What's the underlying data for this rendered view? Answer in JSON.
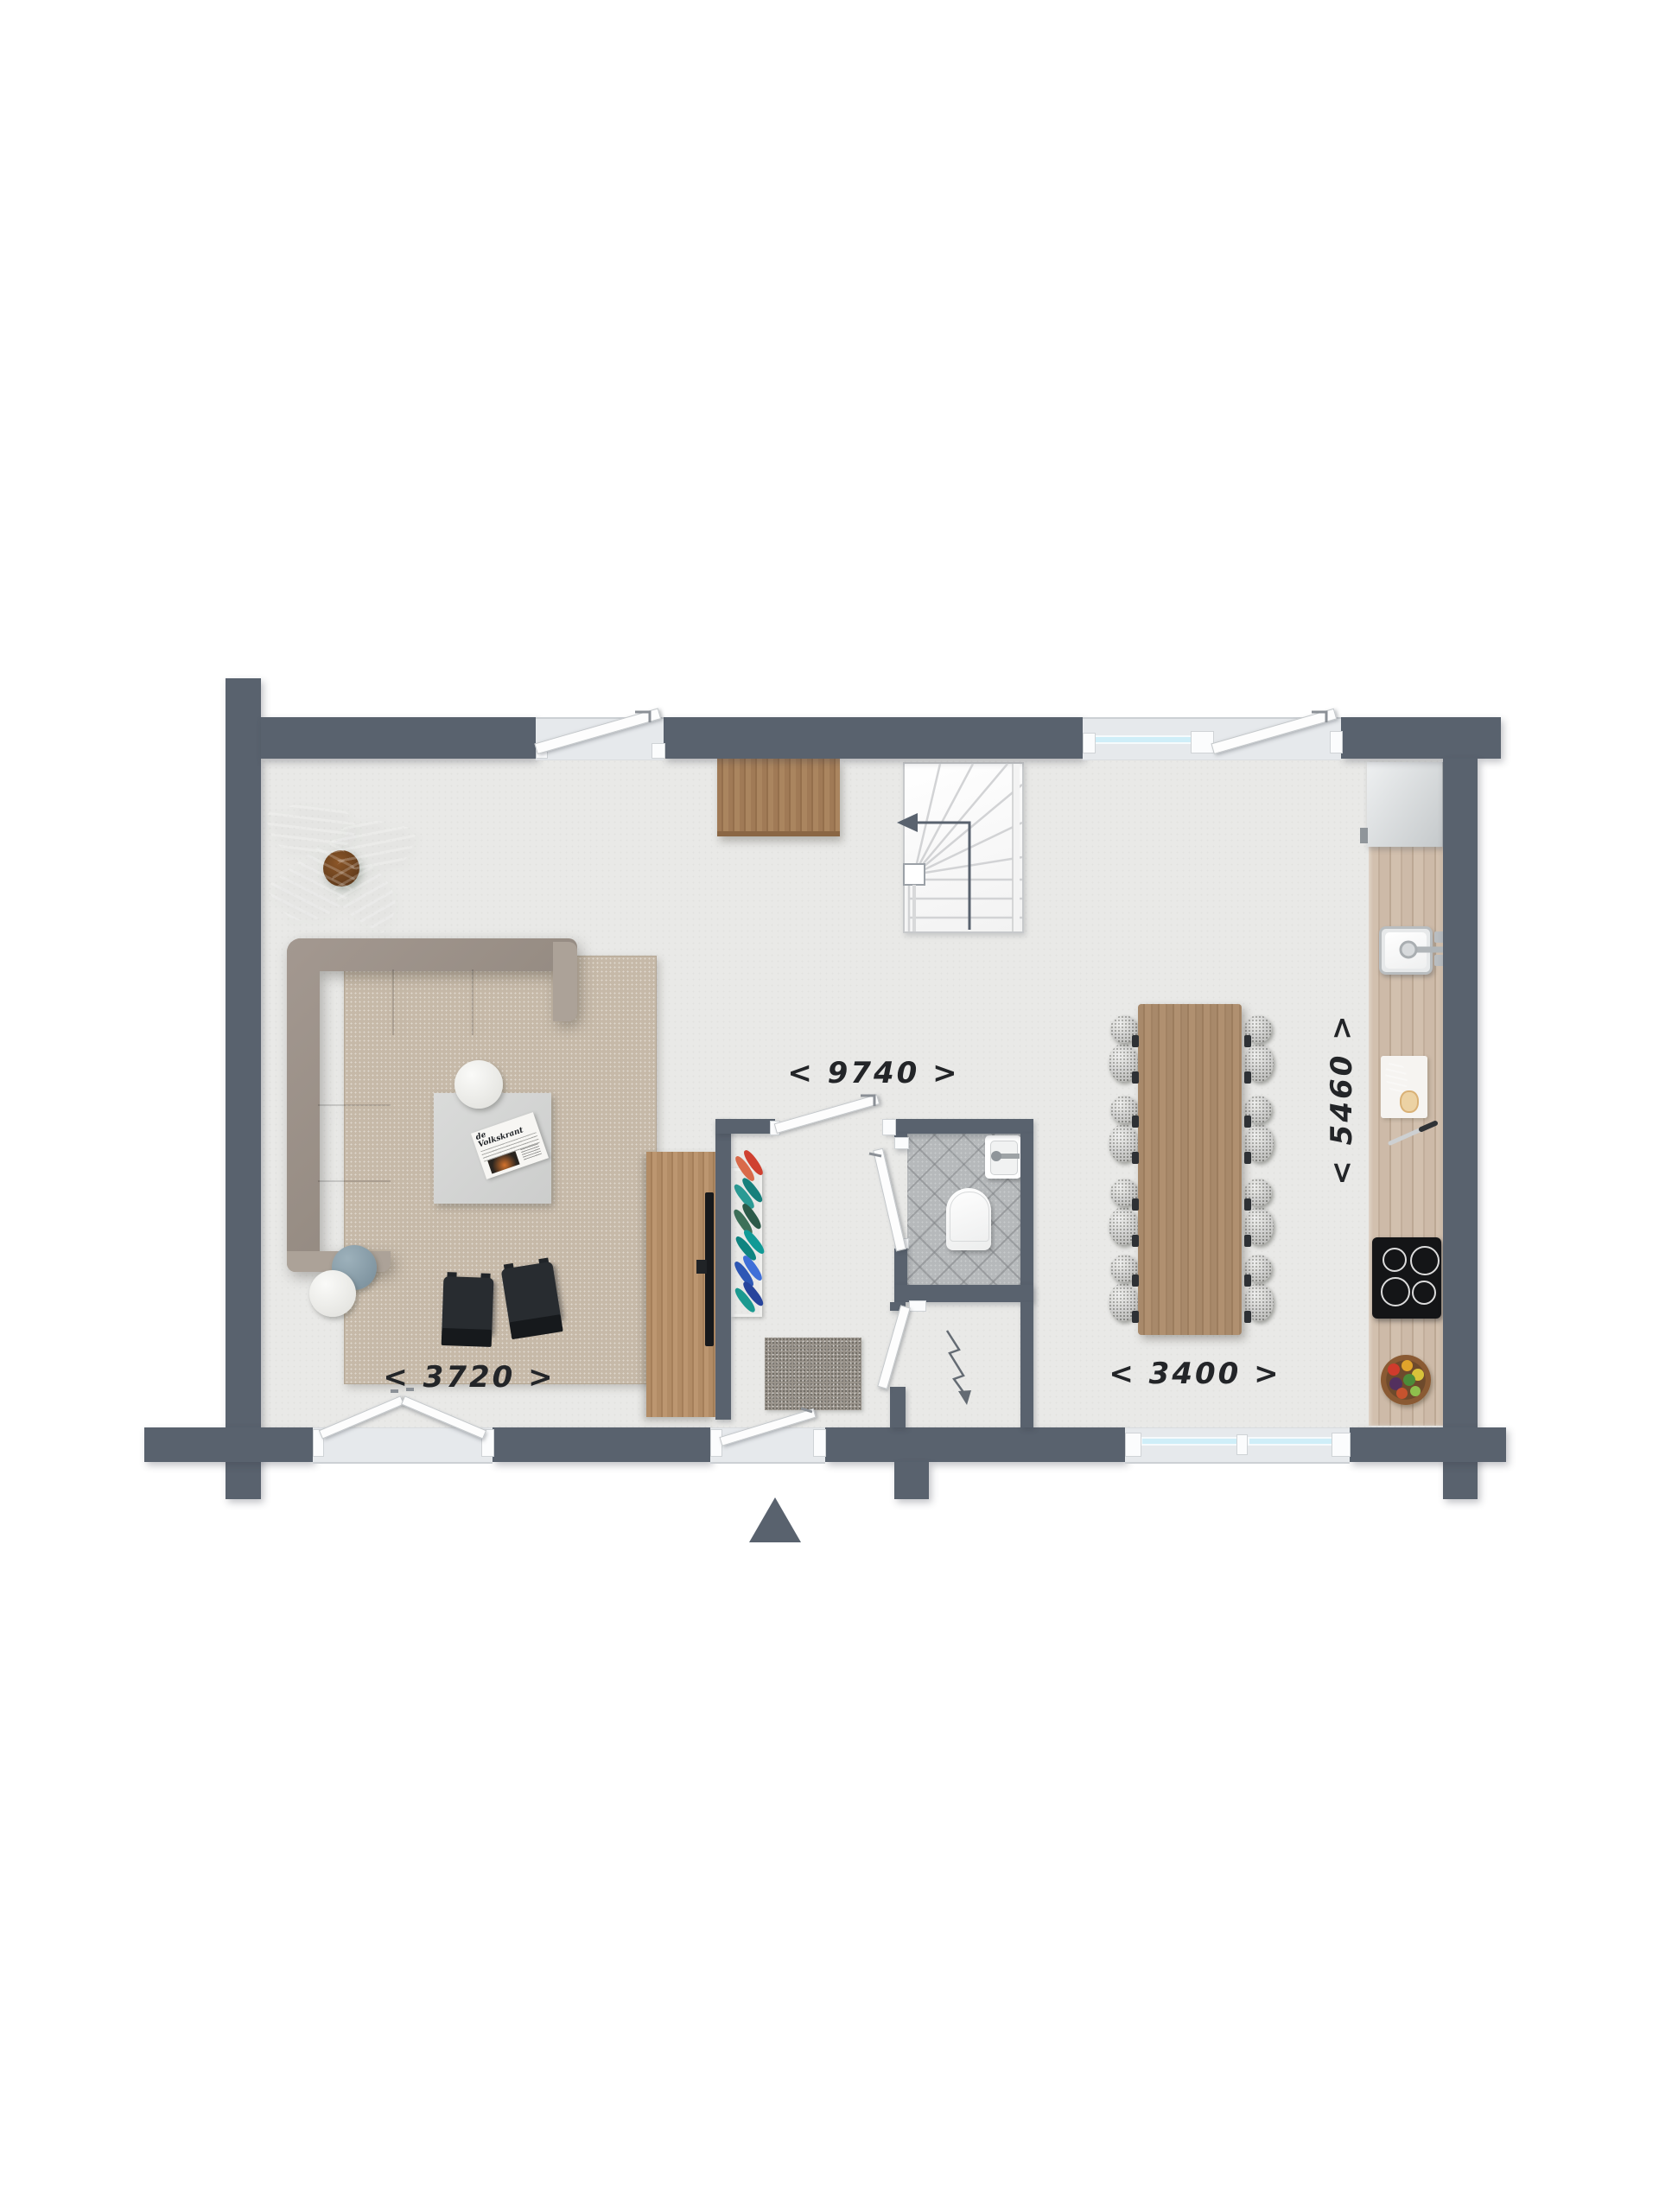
{
  "floorplan": {
    "dimension_labels": {
      "total_width": "< 9740 >",
      "living_room_width": "< 3720 >",
      "dining_area_width": "< 3400 >",
      "depth": "< 5460 >"
    },
    "newspaper_title": "de Volkskrant",
    "colors": {
      "wall": "#59626e",
      "floor": "#e9e9e7",
      "rug": "#c6b9a8",
      "window_glass": "#cfeef8",
      "wood": "#a8896a",
      "tile": "#b6b9bb",
      "sofa": "#a39890",
      "dining_chair": "#7f8370"
    }
  }
}
